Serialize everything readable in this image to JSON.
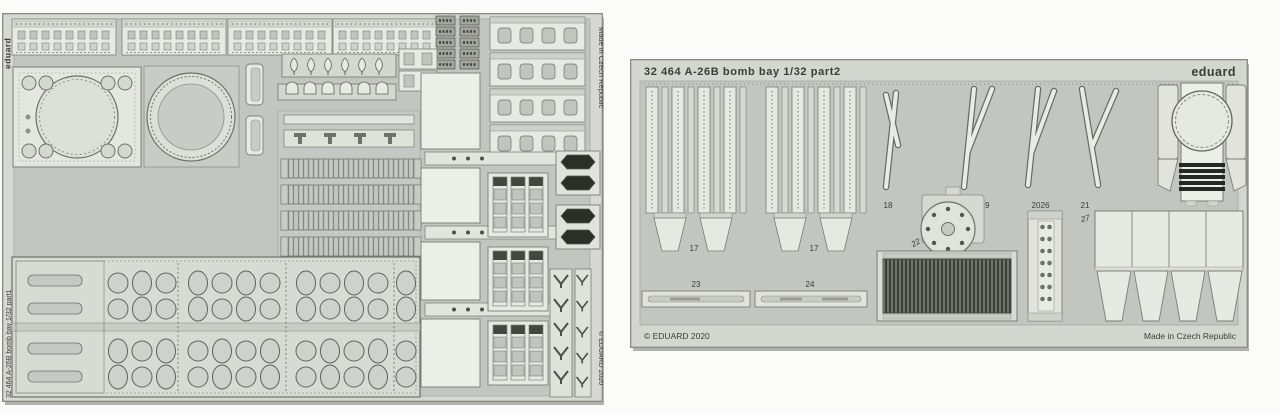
{
  "meta": {
    "description": "Scan of two Eduard photo-etched brass detail frets for the A-26B bomb bay 1/32 model kit"
  },
  "left_sheet": {
    "brand_vertical": "eduard",
    "product_vertical": "32 464  A-26B  bomb bay  1/32  part1",
    "made_in_vertical": "Made in Czech Republic",
    "copyright_vertical": "© EDUARD 2020"
  },
  "right_sheet": {
    "title": "32 464  A-26B  bomb bay  1/32  part2",
    "brand": "eduard",
    "copyright": "© EDUARD 2020",
    "made_in": "Made in Czech Republic",
    "part_labels": {
      "p17a": "17",
      "p17b": "17",
      "p18": "18",
      "p19": "19",
      "p20": "20",
      "p21": "21",
      "p22": "22",
      "p23": "23",
      "p24": "24",
      "p26": "26",
      "p27": "27"
    }
  },
  "colors": {
    "page_background": "#fbfbf9",
    "sheet_frame": "#d6d8d2",
    "sheet_cutout": "#c3c6c0",
    "part_light": "#e8eae4",
    "part_mid": "#d3d5cf",
    "outline": "#7b7e77",
    "dark_detail": "#3f423c",
    "black_part": "#2c2e28",
    "text": "#3b3e37"
  }
}
